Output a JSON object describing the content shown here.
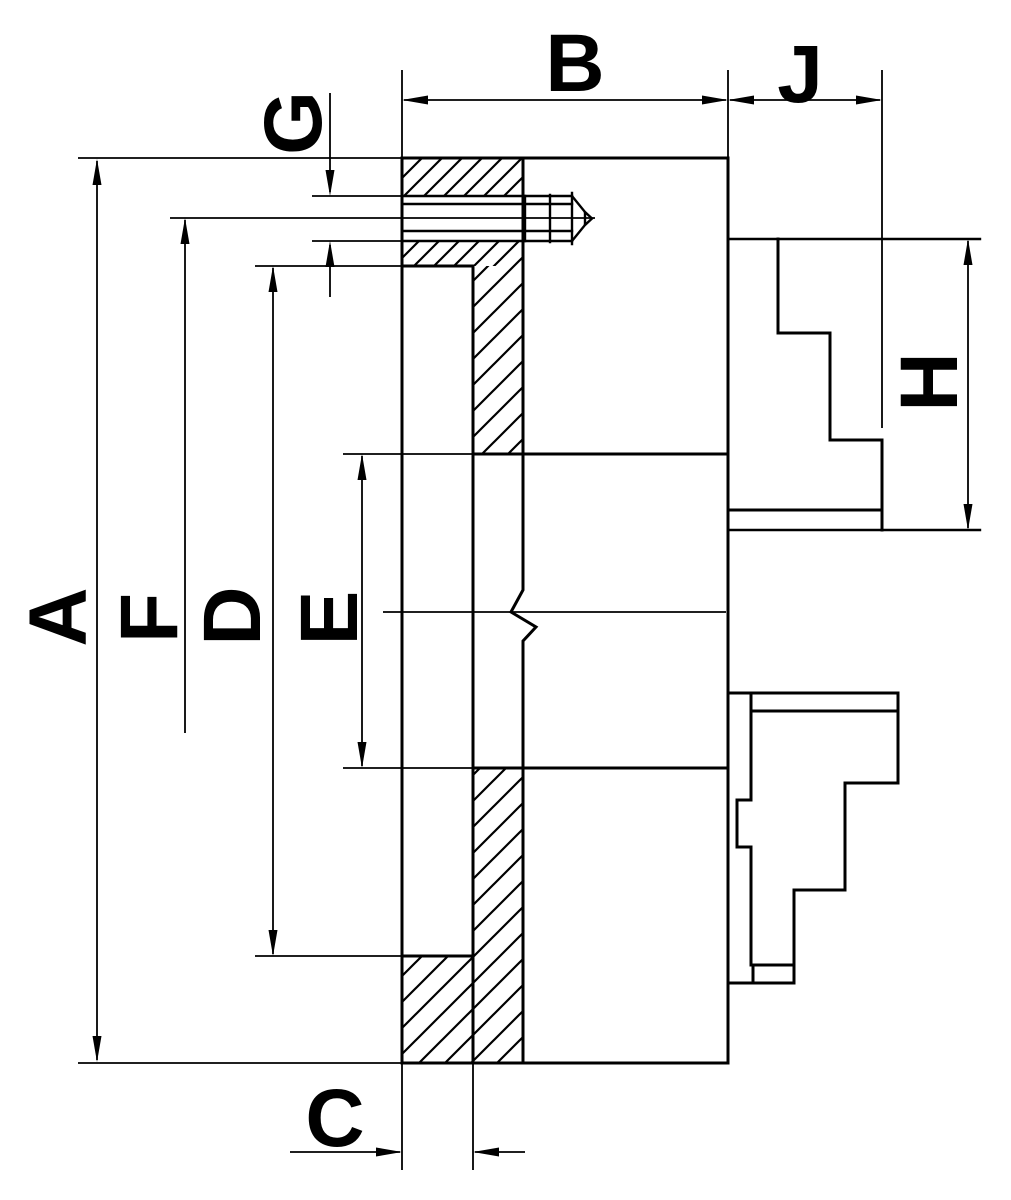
{
  "colors": {
    "ink": "#000000",
    "paper": "#ffffff"
  },
  "labels": {
    "A": "A",
    "B": "B",
    "C": "C",
    "D": "D",
    "E": "E",
    "F": "F",
    "G": "G",
    "H": "H",
    "J": "J"
  }
}
